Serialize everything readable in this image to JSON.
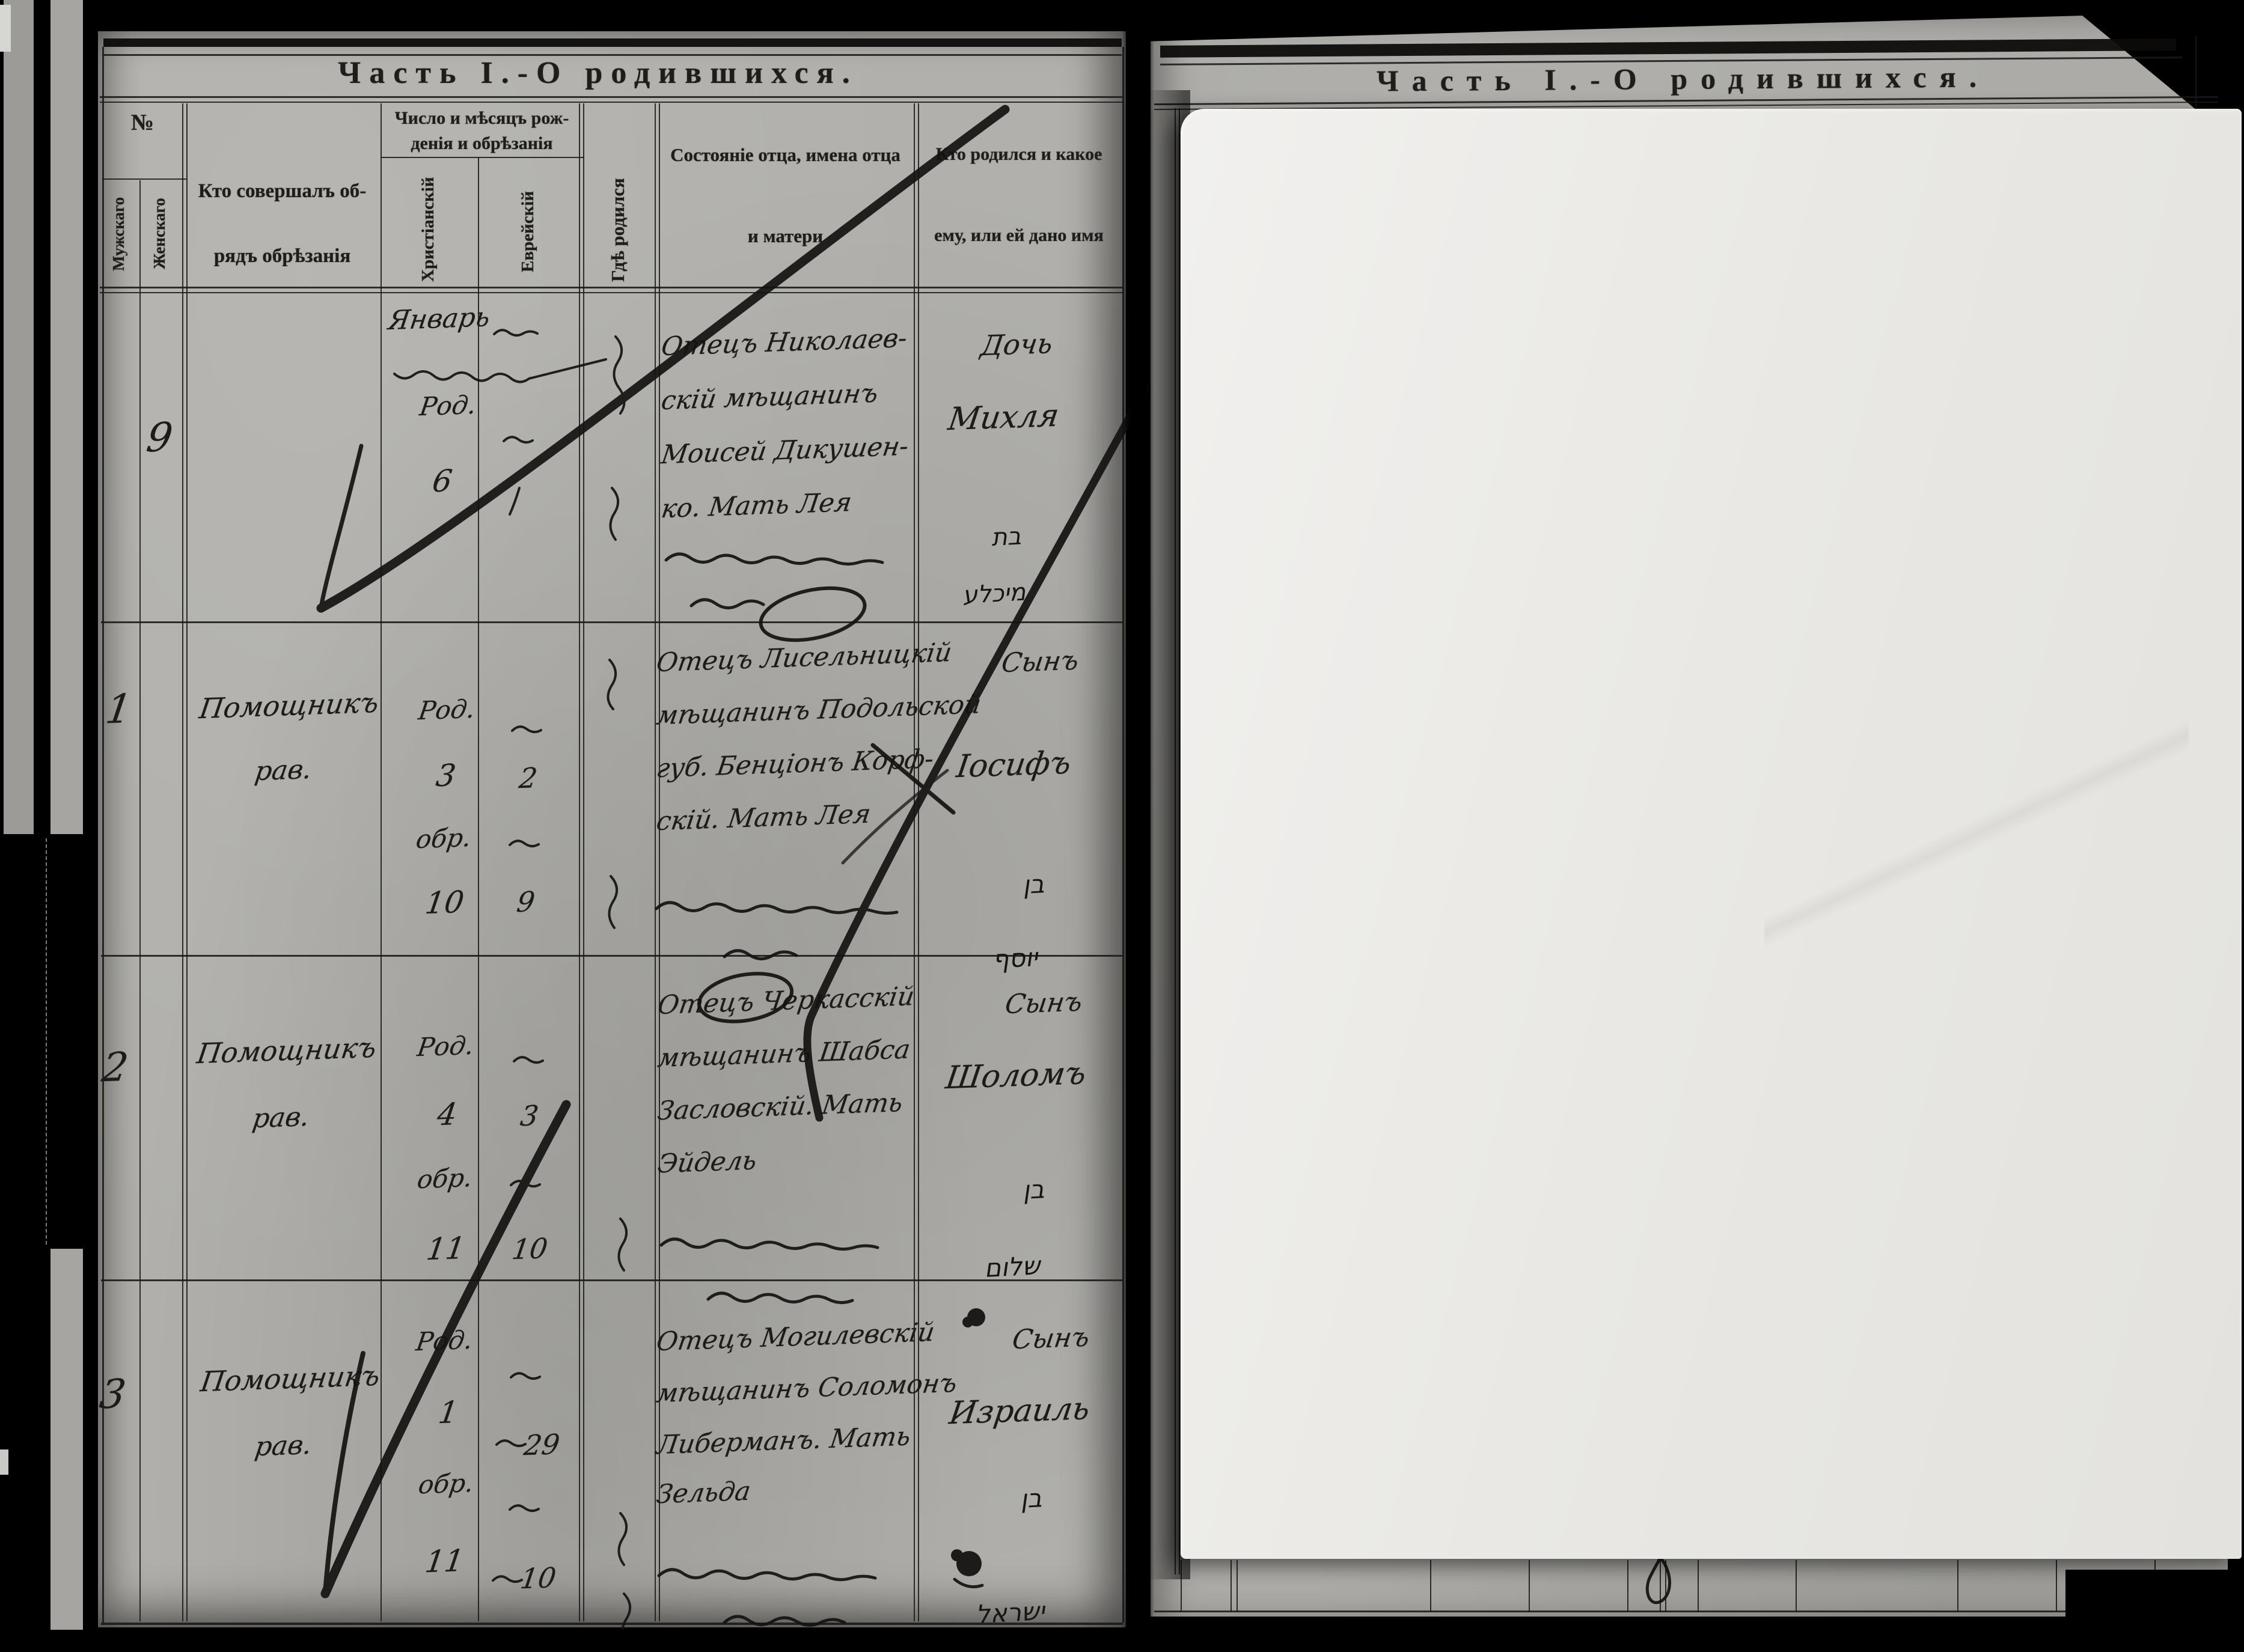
{
  "left_page": {
    "title": "Часть I.-О родившихся.",
    "header": {
      "number": "№",
      "number_male": "Мужскаго",
      "number_female": "Женскаго",
      "performer_line1": "Кто совершалъ об-",
      "performer_line2": "рядъ обрѣзанія",
      "dates_line1": "Число и мѣсяцъ рож-",
      "dates_line2": "денія и обрѣзанія",
      "date_christian": "Христіанскій",
      "date_jewish": "Еврейскій",
      "where_born": "Гдѣ родился",
      "father_line1": "Состояніе отца, имена отца",
      "father_line2": "и матери",
      "child_line1": "Кто родился и какое",
      "child_line2": "ему, или ей дано имя"
    },
    "rows": [
      {
        "entry_no": "9",
        "month": "Январь",
        "christian_birth_label": "Род.",
        "christian_birth_day": "6",
        "father_lines": [
          "Отецъ Николаев-",
          "скій мѣщанинъ",
          "Моисей Дикушен-",
          "ко. Мать Лея"
        ],
        "child_lines": [
          "Дочь",
          "Михля"
        ],
        "hebrew_name_lines": [
          "בת",
          "מיכלע"
        ]
      },
      {
        "entry_no": "1",
        "performer_lines": [
          "Помощникъ",
          "рав."
        ],
        "christian_birth_label": "Род.",
        "christian_birth_day": "3",
        "christian_circ_label": "обр.",
        "christian_circ_day": "10",
        "jewish_birth_day": "2",
        "jewish_circ_day": "9",
        "father_lines": [
          "Отецъ Лисельницкій",
          "мѣщанинъ Подольской",
          "губ. Бенціонъ Корф-",
          "скій. Мать Лея"
        ],
        "child_lines": [
          "Сынъ",
          "Іосифъ"
        ],
        "hebrew_name_lines": [
          "בן",
          "יוסף"
        ]
      },
      {
        "entry_no": "2",
        "performer_lines": [
          "Помощникъ",
          "рав."
        ],
        "christian_birth_label": "Род.",
        "christian_birth_day": "4",
        "christian_circ_label": "обр.",
        "christian_circ_day": "11",
        "jewish_birth_day": "3",
        "jewish_circ_day": "10",
        "father_lines": [
          "Отецъ Черкасскій",
          "мѣщанинъ Шабса",
          "Засловскій. Мать",
          "Эйдель"
        ],
        "child_lines": [
          "Сынъ",
          "Шоломъ"
        ],
        "hebrew_name_lines": [
          "בן",
          "שלום"
        ]
      },
      {
        "entry_no": "3",
        "performer_lines": [
          "Помощникъ",
          "рав."
        ],
        "christian_birth_label": "Род.",
        "christian_birth_day": "1",
        "christian_circ_label": "обр.",
        "christian_circ_day": "11",
        "jewish_birth_day": "29",
        "jewish_circ_day": "10",
        "father_lines": [
          "Отецъ Могилевскій",
          "мѣщанинъ Соломонъ",
          "Либерманъ. Мать",
          "Зельда"
        ],
        "child_lines": [
          "Сынъ",
          "Израиль"
        ],
        "hebrew_name_lines": [
          "בן",
          "ישראל"
        ]
      }
    ]
  },
  "right_page": {
    "title": "Часть I.-О родившихся."
  },
  "colors": {
    "background": "#000000",
    "paper": "#b1b0ac",
    "overlay_sheet": "#edece9",
    "ink": "#1b1b1b"
  }
}
